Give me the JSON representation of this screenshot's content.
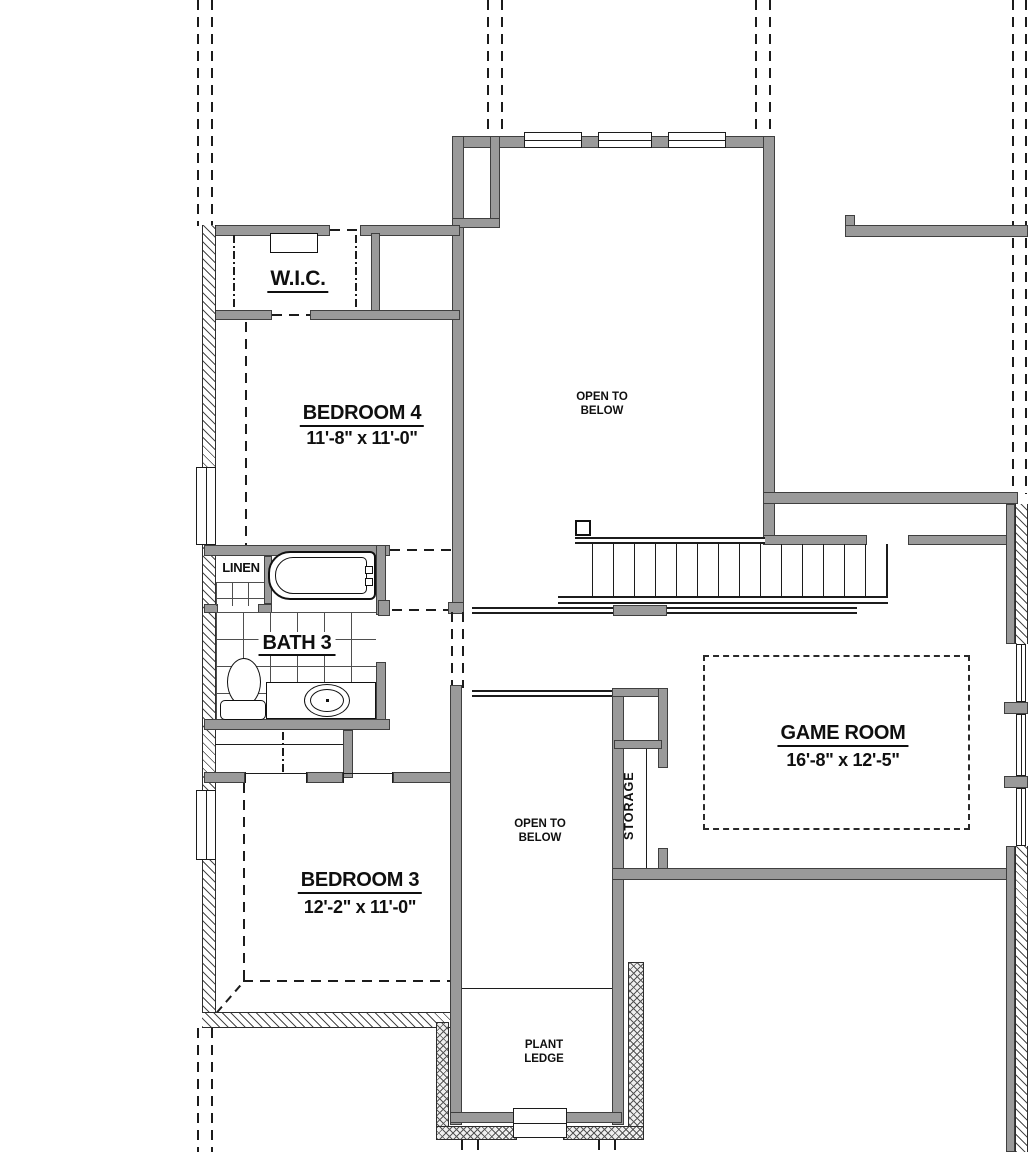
{
  "rooms": {
    "wic": {
      "name": "W.I.C."
    },
    "bedroom4": {
      "name": "BEDROOM 4",
      "dims": "11'-8\" x 11'-0\""
    },
    "open_below_upper": {
      "line1": "OPEN TO",
      "line2": "BELOW"
    },
    "linen": {
      "name": "LINEN"
    },
    "bath3": {
      "name": "BATH 3"
    },
    "game_room": {
      "name": "GAME ROOM",
      "dims": "16'-8\" x 12'-5\""
    },
    "storage": {
      "name": "STORAGE"
    },
    "bedroom3": {
      "name": "BEDROOM 3",
      "dims": "12'-2\" x 11'-0\""
    },
    "open_below_lower": {
      "line1": "OPEN TO",
      "line2": "BELOW"
    },
    "plant_ledge": {
      "line1": "PLANT",
      "line2": "LEDGE"
    }
  },
  "colors": {
    "wall_fill": "#9a9a9a",
    "wall_edge": "#3f3f3f",
    "line": "#1c1c1c",
    "background": "#ffffff"
  }
}
